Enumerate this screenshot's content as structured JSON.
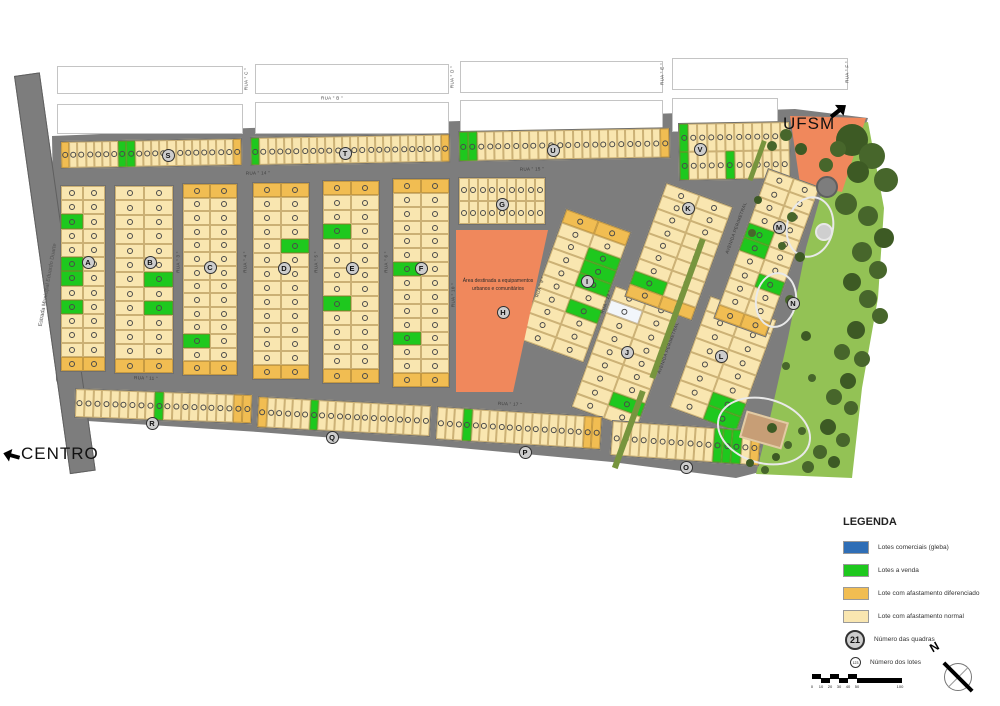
{
  "labels": {
    "ufsm": "UFSM",
    "centro": "CENTRO",
    "estrada": "Estrada Municipal Eduardo Duarte",
    "north": "N"
  },
  "area_h": {
    "line1": "Área destinada a equipamentos",
    "line2": "urbanos e comunitários"
  },
  "legend": {
    "title": "LEGENDA",
    "items": [
      {
        "label": "Lotes comerciais (gleba)",
        "color": "#2f6eb6"
      },
      {
        "label": "Lotes a venda",
        "color": "#1ec81e"
      },
      {
        "label": "Lote com afastamento diferenciado",
        "color": "#f1bd52"
      },
      {
        "label": "Lote com afastamento normal",
        "color": "#f9e6b0"
      }
    ],
    "quadras": {
      "symbol": "21",
      "label": "Número das quadras"
    },
    "lotes": {
      "symbol": "123",
      "label": "Número dos lotes"
    }
  },
  "scalebar": {
    "ticks": [
      "0",
      "10",
      "20",
      "30",
      "40",
      "50",
      "100"
    ],
    "tick_x": [
      2,
      11,
      20,
      29,
      38,
      47,
      90
    ]
  },
  "colors": {
    "road": "#7d7d7d",
    "road_border": "#5f5f5f",
    "lot_normal": "#f9e6b0",
    "lot_diff": "#f1bd52",
    "lot_sale": "#1ec81e",
    "lot_commercial": "#2f6eb6",
    "lot_white": "#f2f6fb",
    "equip": "#f0885c",
    "park": "#93c255",
    "trees": "#47662b",
    "trees_dark": "#3d5a24",
    "median": "#77953e",
    "court": "#c79e76",
    "block_border": "#6f6f6f"
  },
  "map": {
    "footprint": "52,136 250,128 460,121 680,113 795,109 868,118 842,196 812,282 786,372 768,470 736,478 612,462 438,446 258,432 72,420 56,380",
    "park_poly": "836,128 868,122 884,208 878,298 862,388 852,478 756,474 770,418 788,338 806,248 824,184",
    "equip_poly": "790,116 866,118 842,192 800,184",
    "estrada": {
      "x": 14,
      "y": 76,
      "w": 26,
      "h": 402,
      "rot": -8
    },
    "white_blocks": [
      [
        57,
        66,
        186,
        28
      ],
      [
        255,
        64,
        194,
        30
      ],
      [
        460,
        61,
        203,
        32
      ],
      [
        672,
        58,
        176,
        32
      ],
      [
        57,
        104,
        186,
        30
      ],
      [
        255,
        102,
        194,
        32
      ],
      [
        460,
        100,
        203,
        34
      ],
      [
        672,
        98,
        106,
        34
      ]
    ],
    "blocks": [
      {
        "q": "S",
        "x": 60,
        "y": 141,
        "w": 182,
        "h": 28,
        "rot": -1,
        "cols": 22,
        "rows": 1,
        "green": [
          7,
          8
        ],
        "orange": [
          0,
          21
        ]
      },
      {
        "q": "T",
        "x": 250,
        "y": 137,
        "w": 200,
        "h": 29,
        "rot": -1,
        "cols": 24,
        "rows": 1,
        "green": [
          0
        ],
        "orange": [
          23
        ]
      },
      {
        "q": "U",
        "x": 458,
        "y": 131,
        "w": 212,
        "h": 31,
        "rot": -1,
        "cols": 24,
        "rows": 1,
        "green": [
          0,
          1
        ],
        "orange": [
          23
        ]
      },
      {
        "q": "V",
        "x": 678,
        "y": 123,
        "w": 112,
        "h": 58,
        "rot": -1,
        "cols": 12,
        "rows": 2,
        "green": [
          0,
          12,
          17
        ],
        "orange": []
      },
      {
        "q": "A",
        "x": 60,
        "y": 185,
        "w": 46,
        "h": 187,
        "rot": 0,
        "cols": 2,
        "rows": 13,
        "green": [
          4,
          10,
          12,
          16
        ],
        "orange": [
          24,
          25
        ]
      },
      {
        "q": "B",
        "x": 114,
        "y": 185,
        "w": 60,
        "h": 189,
        "rot": 0,
        "cols": 2,
        "rows": 13,
        "green": [
          13,
          17
        ],
        "orange": [
          24,
          25
        ]
      },
      {
        "q": "C",
        "x": 182,
        "y": 183,
        "w": 56,
        "h": 193,
        "rot": 0,
        "cols": 2,
        "rows": 14,
        "green": [
          22
        ],
        "orange": [
          0,
          1,
          26,
          27
        ]
      },
      {
        "q": "D",
        "x": 252,
        "y": 182,
        "w": 58,
        "h": 198,
        "rot": 0,
        "cols": 2,
        "rows": 14,
        "green": [
          9
        ],
        "orange": [
          0,
          1,
          26,
          27
        ]
      },
      {
        "q": "E",
        "x": 322,
        "y": 180,
        "w": 58,
        "h": 204,
        "rot": 0,
        "cols": 2,
        "rows": 14,
        "green": [
          6,
          16
        ],
        "orange": [
          0,
          1,
          26,
          27
        ]
      },
      {
        "q": "F",
        "x": 392,
        "y": 178,
        "w": 58,
        "h": 210,
        "rot": 0,
        "cols": 2,
        "rows": 15,
        "green": [
          12,
          22
        ],
        "orange": [
          0,
          1,
          28,
          29
        ]
      },
      {
        "q": "G",
        "x": 458,
        "y": 177,
        "w": 88,
        "h": 48,
        "rot": 0,
        "cols": 9,
        "rows": 2,
        "green": [],
        "orange": []
      },
      {
        "q": "I",
        "x": 566,
        "y": 208,
        "w": 70,
        "h": 140,
        "rot": 20,
        "cols": 2,
        "rows": 10,
        "green": [
          5,
          7,
          9,
          13
        ],
        "orange": [
          0,
          1
        ]
      },
      {
        "q": "J",
        "x": 615,
        "y": 285,
        "w": 70,
        "h": 130,
        "rot": 20,
        "cols": 2,
        "rows": 9,
        "green": [
          15
        ],
        "orange": [],
        "white": [
          2
        ]
      },
      {
        "q": "K",
        "x": 666,
        "y": 182,
        "w": 72,
        "h": 122,
        "rot": 20,
        "cols": 2,
        "rows": 9,
        "green": [
          14
        ],
        "orange": [
          16,
          17
        ]
      },
      {
        "q": "L",
        "x": 710,
        "y": 295,
        "w": 72,
        "h": 120,
        "rot": 20,
        "cols": 2,
        "rows": 8,
        "green": [
          13,
          15
        ],
        "orange": []
      },
      {
        "q": "M",
        "x": 768,
        "y": 168,
        "w": 56,
        "h": 160,
        "rot": 20,
        "cols": 2,
        "rows": 11,
        "green": [
          8,
          10,
          15
        ],
        "orange": [
          20,
          21
        ]
      },
      {
        "q": "R",
        "x": 75,
        "y": 388,
        "w": 178,
        "h": 30,
        "rot": 2,
        "cols": 20,
        "rows": 1,
        "green": [
          9
        ],
        "orange": [
          18,
          19
        ]
      },
      {
        "q": "Q",
        "x": 258,
        "y": 396,
        "w": 174,
        "h": 32,
        "rot": 3,
        "cols": 20,
        "rows": 1,
        "green": [
          6
        ],
        "orange": [
          0
        ]
      },
      {
        "q": "P",
        "x": 437,
        "y": 406,
        "w": 166,
        "h": 34,
        "rot": 3.5,
        "cols": 19,
        "rows": 1,
        "green": [
          3
        ],
        "orange": [
          17,
          18
        ]
      },
      {
        "q": "O",
        "x": 612,
        "y": 420,
        "w": 150,
        "h": 36,
        "rot": 4,
        "cols": 16,
        "rows": 1,
        "green": [
          11,
          12,
          13
        ],
        "orange": [
          15
        ]
      }
    ],
    "area_h": {
      "x": 456,
      "y": 230,
      "w": 92,
      "h": 162
    },
    "markers": [
      [
        "A",
        88,
        262
      ],
      [
        "B",
        150,
        262
      ],
      [
        "C",
        210,
        267
      ],
      [
        "D",
        284,
        268
      ],
      [
        "E",
        352,
        268
      ],
      [
        "F",
        421,
        268
      ],
      [
        "G",
        502,
        204
      ],
      [
        "H",
        503,
        312
      ],
      [
        "I",
        587,
        281
      ],
      [
        "J",
        627,
        352
      ],
      [
        "K",
        688,
        208
      ],
      [
        "L",
        721,
        356
      ],
      [
        "M",
        779,
        227
      ],
      [
        "N",
        793,
        303
      ],
      [
        "O",
        686,
        467
      ],
      [
        "P",
        525,
        452
      ],
      [
        "Q",
        332,
        437
      ],
      [
        "R",
        152,
        423
      ],
      [
        "S",
        168,
        155
      ],
      [
        "T",
        345,
        153
      ],
      [
        "U",
        553,
        150
      ],
      [
        "V",
        700,
        149
      ]
    ],
    "streets": [
      {
        "t": "RUA \" B \"",
        "x": 332,
        "y": 98,
        "r": 0
      },
      {
        "t": "RUA \" C \"",
        "x": 246,
        "y": 79,
        "r": -90
      },
      {
        "t": "RUA \" D \"",
        "x": 452,
        "y": 77,
        "r": -90
      },
      {
        "t": "RUA \" E \"",
        "x": 662,
        "y": 74,
        "r": -90
      },
      {
        "t": "RUA \" F \"",
        "x": 847,
        "y": 72,
        "r": -90
      },
      {
        "t": "RUA \" 14 \"",
        "x": 258,
        "y": 173,
        "r": -1
      },
      {
        "t": "RUA \" 15 \"",
        "x": 532,
        "y": 169,
        "r": -1
      },
      {
        "t": "RUA \" 3 \"",
        "x": 178,
        "y": 262,
        "r": -90
      },
      {
        "t": "RUA \" 4 \"",
        "x": 245,
        "y": 262,
        "r": -90
      },
      {
        "t": "RUA \" 5 \"",
        "x": 316,
        "y": 262,
        "r": -90
      },
      {
        "t": "RUA \" 6 \"",
        "x": 386,
        "y": 262,
        "r": -90
      },
      {
        "t": "RUA \" 10 \"",
        "x": 453,
        "y": 295,
        "r": -90
      },
      {
        "t": "RUA \" 9 \"",
        "x": 540,
        "y": 287,
        "r": -72
      },
      {
        "t": "RUA \" 11 \"",
        "x": 146,
        "y": 378,
        "r": 2
      },
      {
        "t": "RUA \" 17 \"",
        "x": 510,
        "y": 404,
        "r": 3
      },
      {
        "t": "RUA \" 12 \"",
        "x": 606,
        "y": 302,
        "r": -70
      },
      {
        "t": "AVENIDA PERIMETRAL",
        "x": 736,
        "y": 228,
        "r": -70
      },
      {
        "t": "AVENIDA PERIMETRAL",
        "x": 668,
        "y": 348,
        "r": -70
      }
    ],
    "medians": [
      [
        700,
        238,
        6,
        148
      ],
      [
        640,
        390,
        6,
        82
      ],
      [
        762,
        140,
        5,
        42
      ]
    ],
    "trees": [
      [
        852,
        140,
        16
      ],
      [
        872,
        156,
        13
      ],
      [
        886,
        180,
        12
      ],
      [
        858,
        172,
        11
      ],
      [
        846,
        204,
        11
      ],
      [
        868,
        216,
        10
      ],
      [
        884,
        238,
        10
      ],
      [
        862,
        252,
        10
      ],
      [
        878,
        270,
        9
      ],
      [
        852,
        282,
        9
      ],
      [
        868,
        299,
        9
      ],
      [
        880,
        316,
        8
      ],
      [
        856,
        330,
        9
      ],
      [
        842,
        352,
        8
      ],
      [
        862,
        359,
        8
      ],
      [
        848,
        381,
        8
      ],
      [
        834,
        397,
        8
      ],
      [
        851,
        408,
        7
      ],
      [
        828,
        427,
        8
      ],
      [
        843,
        440,
        7
      ],
      [
        820,
        452,
        7
      ],
      [
        834,
        462,
        6
      ],
      [
        808,
        467,
        6
      ],
      [
        790,
        300,
        5
      ],
      [
        800,
        257,
        5
      ],
      [
        792,
        217,
        5
      ],
      [
        782,
        246,
        4
      ],
      [
        806,
        336,
        5
      ],
      [
        786,
        366,
        4
      ],
      [
        812,
        378,
        4
      ],
      [
        772,
        428,
        5
      ],
      [
        788,
        445,
        4
      ],
      [
        802,
        431,
        4
      ],
      [
        776,
        457,
        4
      ],
      [
        838,
        149,
        8
      ],
      [
        826,
        165,
        7
      ],
      [
        801,
        149,
        6
      ],
      [
        786,
        135,
        6
      ],
      [
        772,
        146,
        5
      ],
      [
        758,
        200,
        4
      ],
      [
        752,
        233,
        4
      ],
      [
        765,
        470,
        4
      ],
      [
        750,
        463,
        4
      ]
    ],
    "paths": [
      [
        786,
        196,
        48,
        62,
        12
      ],
      [
        755,
        272,
        42,
        56,
        8
      ],
      [
        716,
        398,
        96,
        66,
        16
      ]
    ],
    "plaza": {
      "x": 822,
      "y": 230,
      "r": 7
    },
    "roundabout": {
      "x": 816,
      "y": 176,
      "d": 22
    },
    "court": {
      "x": 742,
      "y": 416,
      "w": 44,
      "h": 28,
      "rot": 16
    }
  }
}
